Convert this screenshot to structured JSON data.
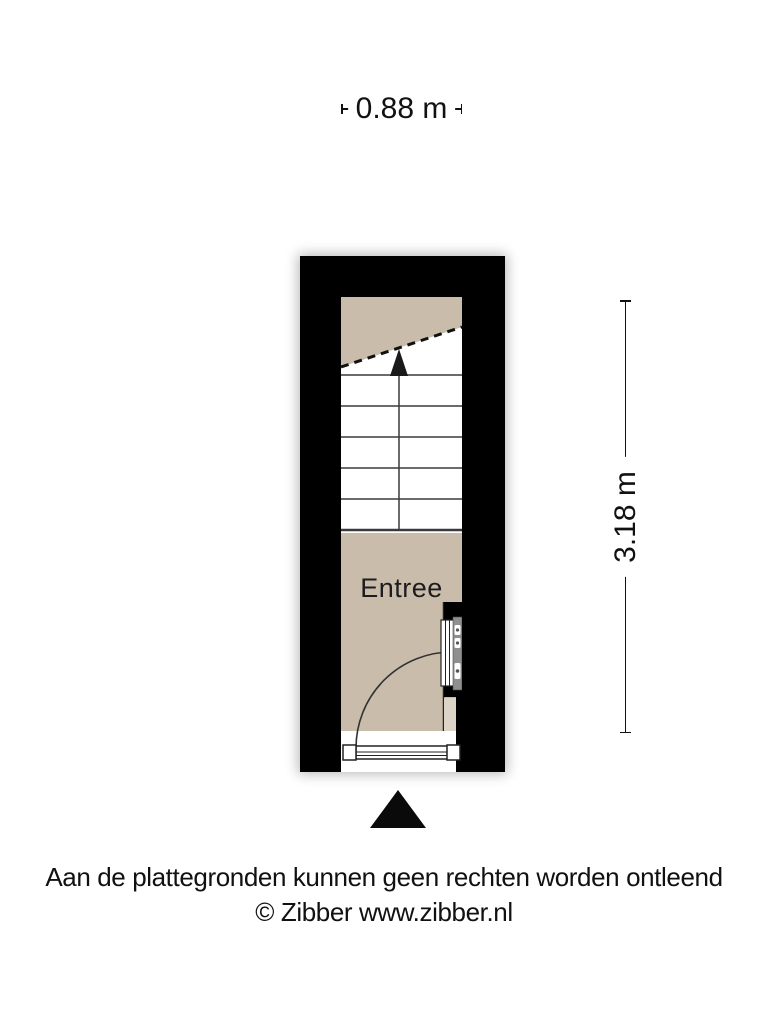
{
  "page": {
    "background": "#ffffff"
  },
  "dimensions": {
    "width_label": "0.88 m",
    "height_label": "3.18 m"
  },
  "floorplan": {
    "room_label": "Entree",
    "features": [
      {
        "name": "staircase-up",
        "icon": "stairs-up-arrow"
      },
      {
        "name": "stair-break",
        "icon": "dashed-break-line"
      },
      {
        "name": "front-door",
        "icon": "door-swing-arc"
      },
      {
        "name": "radiator",
        "icon": "radiator-panel"
      },
      {
        "name": "entrance-marker",
        "icon": "up-triangle"
      }
    ],
    "colors": {
      "wall": "#000000",
      "floor": "#c9bcab",
      "niche_floor": "#dcd4c7",
      "stair_line": "#3a3a3a",
      "fixture_gray": "#8f8f8f"
    }
  },
  "footer": {
    "disclaimer": "Aan de plattegronden kunnen geen rechten worden ontleend",
    "copyright": "© Zibber www.zibber.nl"
  }
}
